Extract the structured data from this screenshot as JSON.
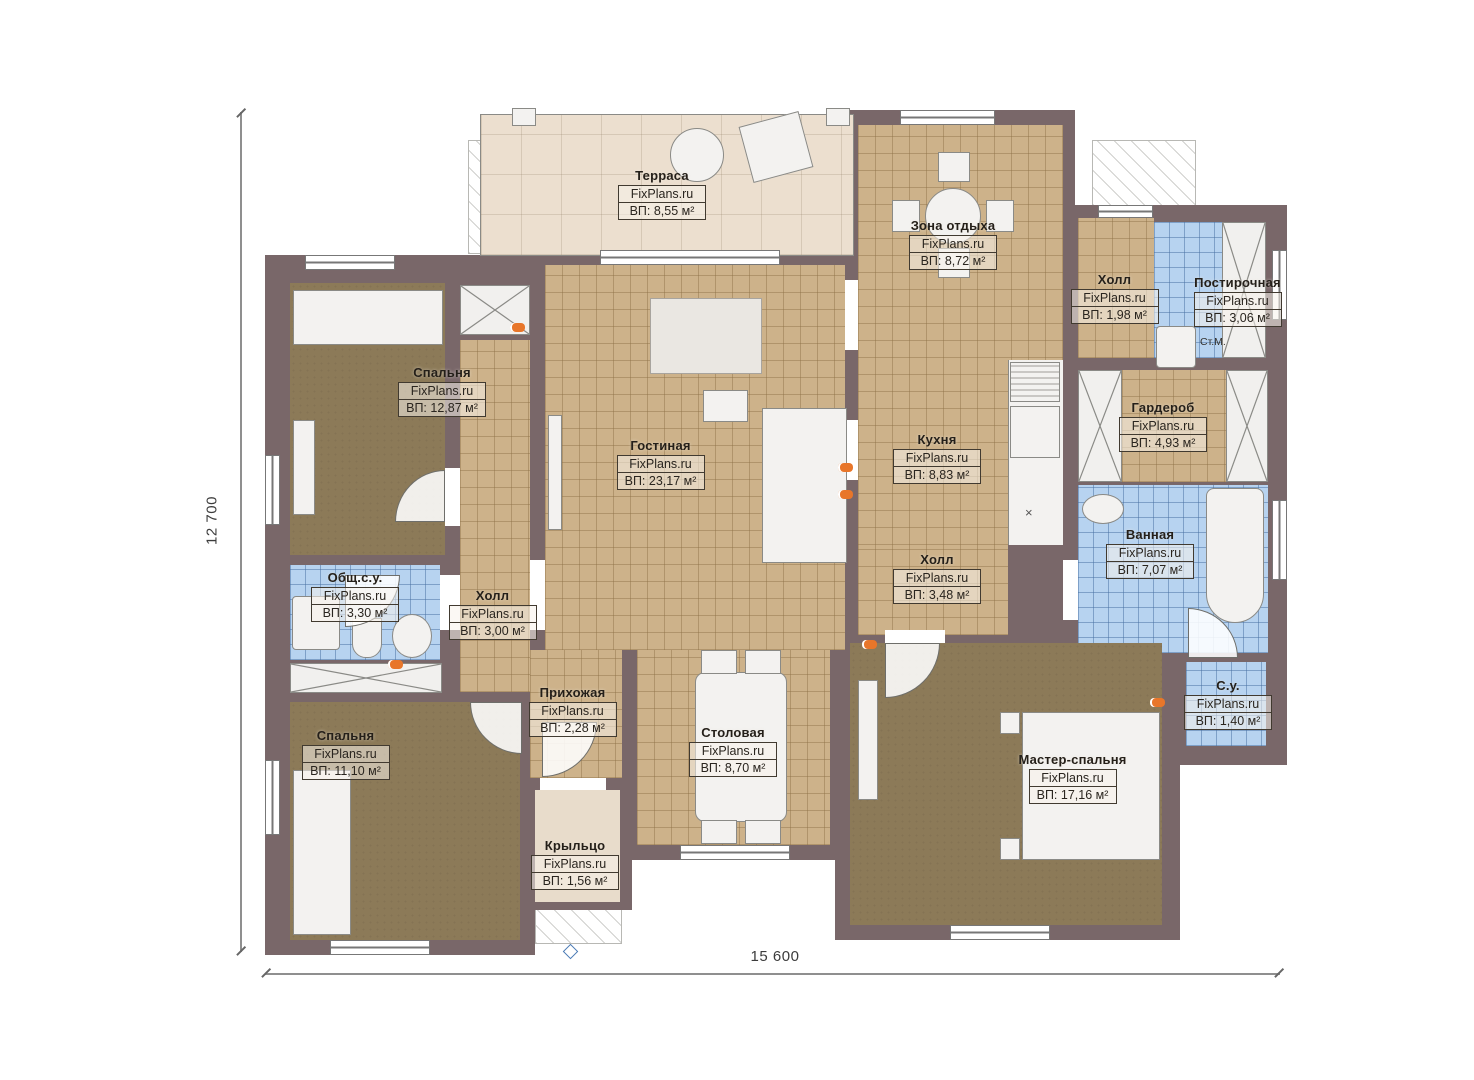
{
  "watermark": "FixPlans.ru",
  "dimensions": {
    "height_label": "12 700",
    "width_label": "15 600"
  },
  "rooms": [
    {
      "name": "Терраса",
      "area": "ВП: 8,55 м²"
    },
    {
      "name": "Зона отдыха",
      "area": "ВП: 8,72 м²"
    },
    {
      "name": "Холл",
      "area": "ВП: 1,98 м²"
    },
    {
      "name": "Постирочная",
      "area": "ВП: 3,06 м²"
    },
    {
      "name": "Спальня",
      "area": "ВП: 12,87 м²"
    },
    {
      "name": "Гостиная",
      "area": "ВП: 23,17 м²"
    },
    {
      "name": "Кухня",
      "area": "ВП: 8,83 м²"
    },
    {
      "name": "Гардероб",
      "area": "ВП: 4,93 м²"
    },
    {
      "name": "Ванная",
      "area": "ВП: 7,07 м²"
    },
    {
      "name": "Общ.с.у.",
      "area": "ВП: 3,30 м²"
    },
    {
      "name": "Холл",
      "area": "ВП: 3,00 м²"
    },
    {
      "name": "Холл",
      "area": "ВП: 3,48 м²"
    },
    {
      "name": "Спальня",
      "area": "ВП: 11,10 м²"
    },
    {
      "name": "Прихожая",
      "area": "ВП: 2,28 м²"
    },
    {
      "name": "Столовая",
      "area": "ВП: 8,70 м²"
    },
    {
      "name": "Мастер-спальня",
      "area": "ВП: 17,16 м²"
    },
    {
      "name": "С.у.",
      "area": "ВП: 1,40 м²"
    },
    {
      "name": "Крыльцо",
      "area": "ВП: 1,56 м²"
    }
  ],
  "annotations": {
    "washer": "Ст.М.",
    "kitchen_mark": "×"
  },
  "colors": {
    "wall": "#796769",
    "floor_tan": "#cdb28a",
    "floor_brown": "#8c7a58",
    "floor_blue": "#b7d3f0",
    "terrace": "#ecdfcf",
    "accent_orange": "#e8762a"
  }
}
